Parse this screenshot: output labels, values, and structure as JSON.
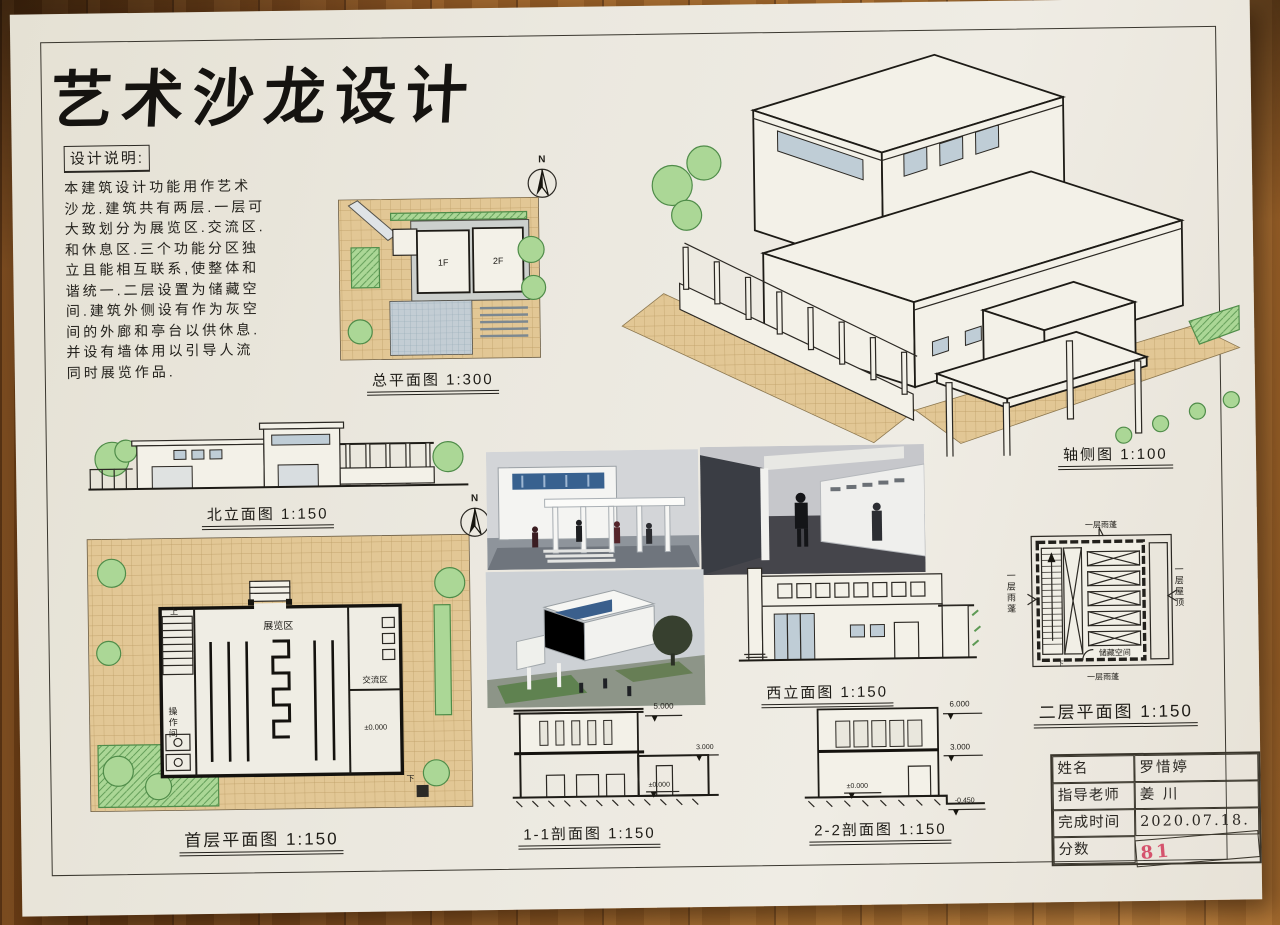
{
  "title": "艺术沙龙设计",
  "notes": {
    "title": "设计说明:",
    "text": "本建筑设计功能用作艺术\n沙龙.建筑共有两层.一层可\n大致划分为展览区.交流区.\n和休息区.三个功能分区独\n立且能相互联系,使整体和\n谐统一.二层设置为储藏空\n间.建筑外侧设有作为灰空\n间的外廊和亭台以供休息.\n并设有墙体用以引导人流\n同时展览作品."
  },
  "north": {
    "letter": "N"
  },
  "site": {
    "label": "总平面图 1:300",
    "f1": "1F",
    "f2": "2F"
  },
  "elev_n": {
    "label": "北立面图 1:150"
  },
  "plan1": {
    "label": "首层平面图 1:150",
    "exhibition": "展览区",
    "exchange": "交流区",
    "workroom": "操作间",
    "level": "±0.000",
    "up": "上",
    "down": "下"
  },
  "axon": {
    "label": "轴侧图 1:100"
  },
  "elev_w": {
    "label": "西立面图 1:150"
  },
  "plan2": {
    "label": "二层平面图 1:150",
    "storage": "储藏空间",
    "canopy_top": "一层雨蓬",
    "canopy_left": "一层雨蓬",
    "canopy_bottom": "一层雨蓬",
    "roof_right": "一层屋顶",
    "down": "下"
  },
  "sec1": {
    "label": "1-1剖面图 1:150",
    "lv5": "5.000",
    "lv3": "3.000",
    "lv0": "±0.000"
  },
  "sec2": {
    "label": "2-2剖面图 1:150",
    "lv6": "6.000",
    "lv3": "3.000",
    "lv0": "±0.000",
    "lvb": "-0.450"
  },
  "tb": {
    "k1": "姓名",
    "v1": "罗惜婷",
    "k2": "指导老师",
    "v2": "姜 川",
    "k3": "完成时间",
    "v3": "2020.07.18.",
    "k4": "分数",
    "v4": "81"
  },
  "colors": {
    "paper": "#e9e5da",
    "ink": "#2b2823",
    "paving": "#e2c795",
    "vegetation": "#abd796",
    "glazing": "#bfcdd6",
    "score_red": "#d5536d",
    "wood": "#8a5322"
  }
}
